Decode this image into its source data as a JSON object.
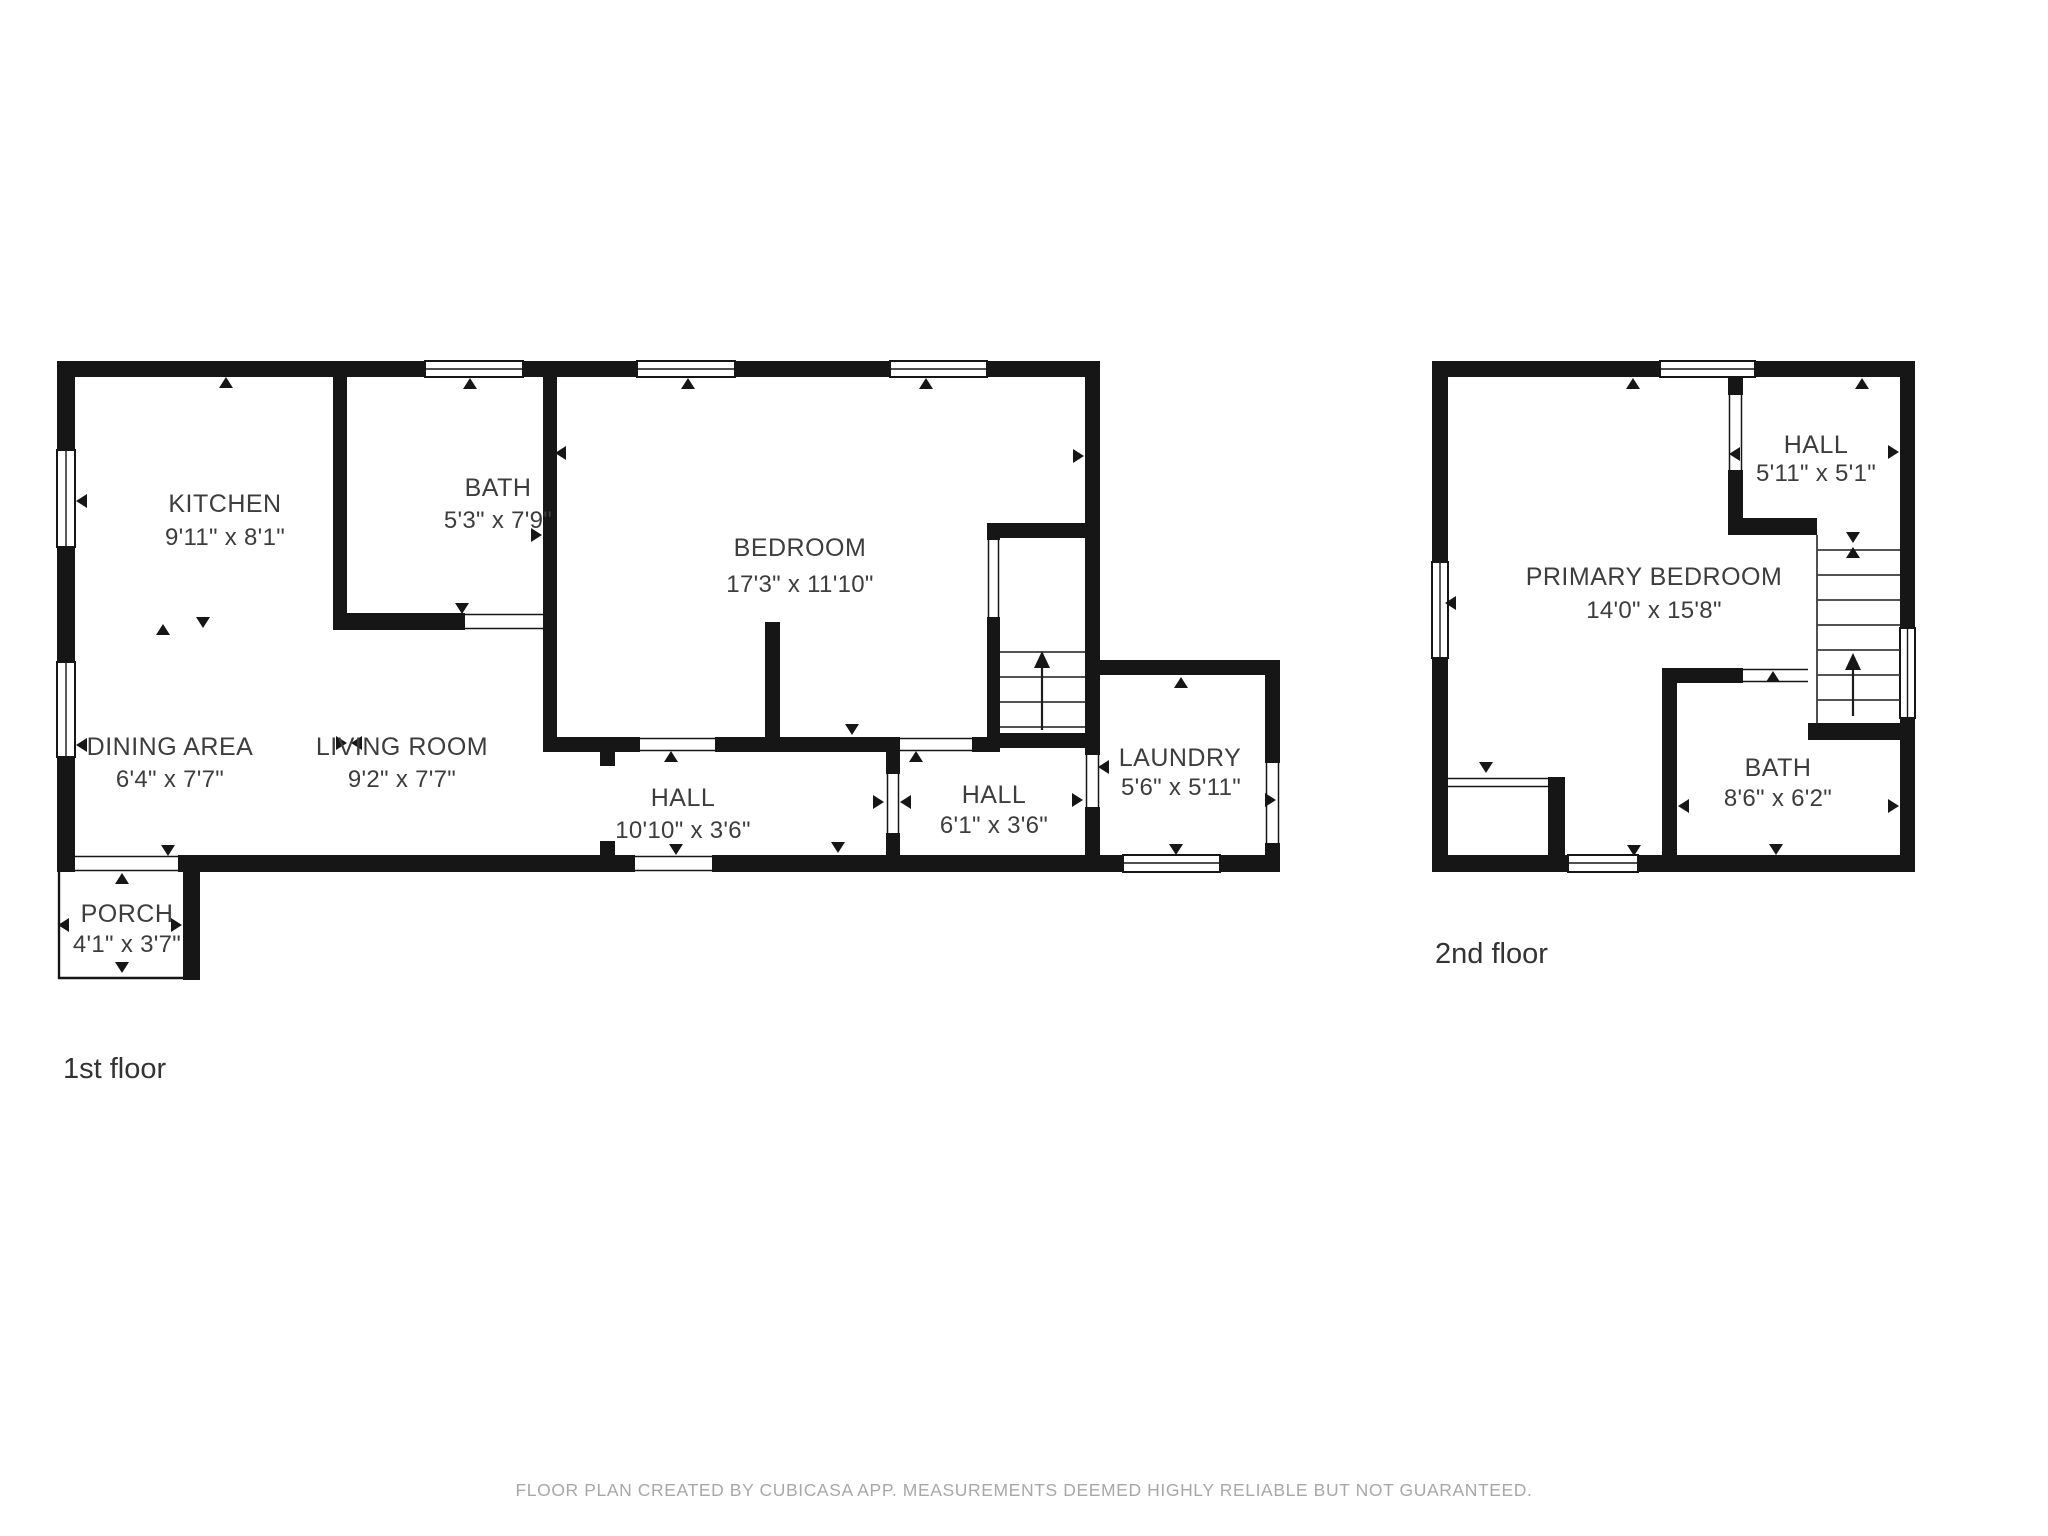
{
  "first_floor": {
    "label": "1st floor",
    "kitchen": {
      "name": "KITCHEN",
      "dims": "9'11\" x 8'1\""
    },
    "bath": {
      "name": "BATH",
      "dims": "5'3\" x 7'9\""
    },
    "bedroom": {
      "name": "BEDROOM",
      "dims": "17'3\" x 11'10\""
    },
    "dining": {
      "name": "DINING AREA",
      "dims": "6'4\" x 7'7\""
    },
    "living": {
      "name": "LIVING ROOM",
      "dims": "9'2\" x 7'7\""
    },
    "hall_long": {
      "name": "HALL",
      "dims": "10'10\" x 3'6\""
    },
    "hall_short": {
      "name": "HALL",
      "dims": "6'1\" x 3'6\""
    },
    "laundry": {
      "name": "LAUNDRY",
      "dims": "5'6\" x 5'11\""
    },
    "porch": {
      "name": "PORCH",
      "dims": "4'1\" x 3'7\""
    }
  },
  "second_floor": {
    "label": "2nd floor",
    "hall": {
      "name": "HALL",
      "dims": "5'11\" x 5'1\""
    },
    "primary_bedroom": {
      "name": "PRIMARY BEDROOM",
      "dims": "14'0\" x 15'8\""
    },
    "bath": {
      "name": "BATH",
      "dims": "8'6\" x 6'2\""
    }
  },
  "footer": {
    "disclaimer": "FLOOR PLAN CREATED BY CUBICASA APP. MEASUREMENTS DEEMED HIGHLY RELIABLE BUT NOT GUARANTEED."
  },
  "colors": {
    "wall": "#161616",
    "room_text": "#3d3d3d",
    "floor_label_text": "#333333",
    "footer_text": "#a8a8a8",
    "background": "#ffffff"
  }
}
